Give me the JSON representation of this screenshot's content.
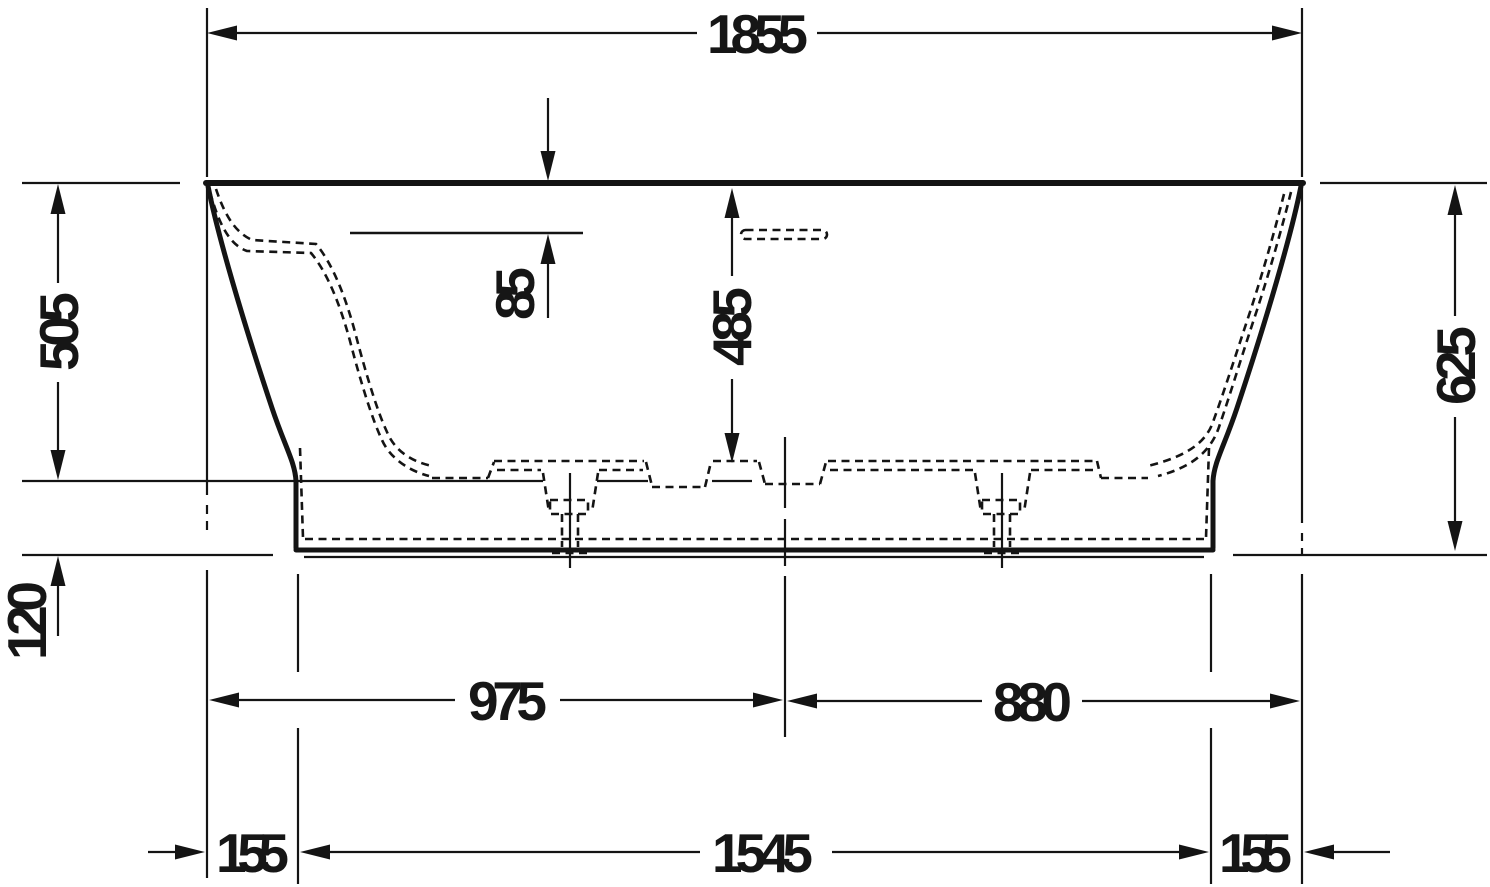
{
  "drawing": {
    "kind": "technical-dimension-drawing",
    "subject": "bathtub-side-elevation",
    "ink_color": "#141414",
    "paper_color": "#ffffff",
    "dims": {
      "overall_width": "1855",
      "rim_to_sump_height": "505",
      "plinth_height": "120",
      "rim_to_ledge": "85",
      "inner_depth": "485",
      "overall_height": "625",
      "center_from_left": "975",
      "center_from_right": "880",
      "base_length": "1545",
      "base_inset_left": "155",
      "base_inset_right": "155"
    }
  }
}
